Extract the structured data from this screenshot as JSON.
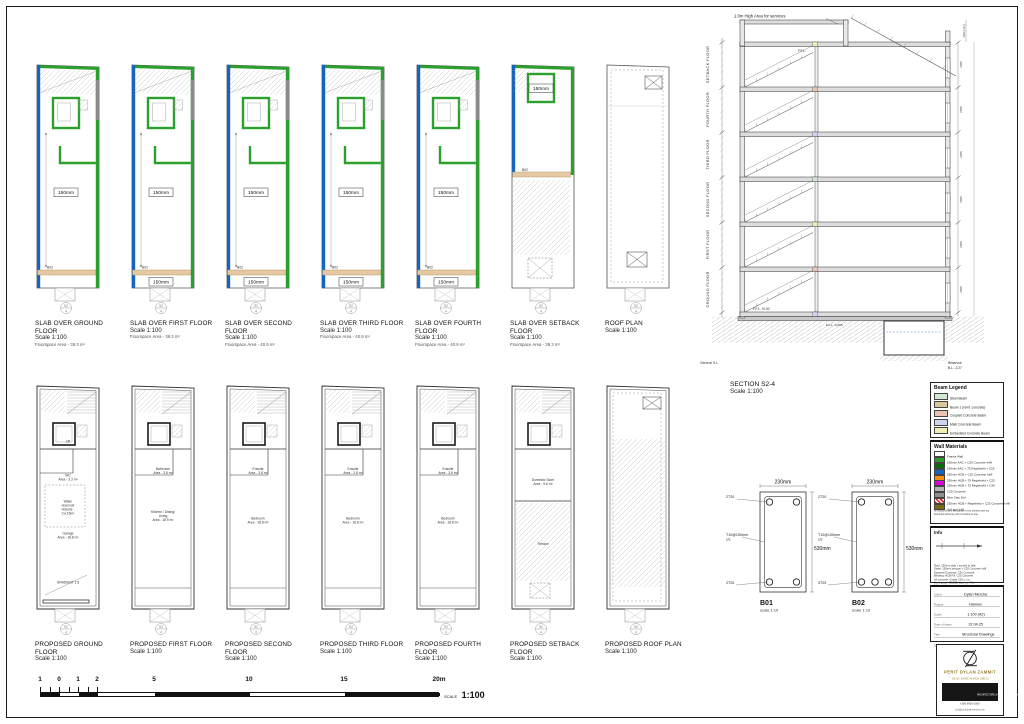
{
  "marker": {
    "top": "S2",
    "bottom": "4"
  },
  "plan_colors": {
    "blue": "#1565c0",
    "green": "#2ca02c",
    "gray": "#8a8a8a",
    "beam": "#e6c9a3"
  },
  "slab_plans": [
    {
      "title": "SLAB OVER GROUND FLOOR",
      "scale": "Scale 1:100",
      "area": "Floorspace Area - 39.3 m²",
      "variant": "slab",
      "center_label": "150mm",
      "bottom_label": "",
      "beam_label": "B02"
    },
    {
      "title": "SLAB OVER FIRST FLOOR",
      "scale": "Scale 1:100",
      "area": "Floorspace Area - 39.3 m²",
      "variant": "slab",
      "center_label": "150mm",
      "bottom_label": "150mm",
      "beam_label": "B02"
    },
    {
      "title": "SLAB OVER SECOND FLOOR",
      "scale": "Scale 1:100",
      "area": "Floorspace Area - 40.9 m²",
      "variant": "slab",
      "center_label": "150mm",
      "bottom_label": "150mm",
      "beam_label": "B02"
    },
    {
      "title": "SLAB OVER THIRD FLOOR",
      "scale": "Scale 1:100",
      "area": "Floorspace Area - 40.9 m²",
      "variant": "slab",
      "center_label": "150mm",
      "bottom_label": "150mm",
      "beam_label": "B02"
    },
    {
      "title": "SLAB OVER FOURTH FLOOR",
      "scale": "Scale 1:100",
      "area": "Floorspace Area - 40.9 m²",
      "variant": "slab",
      "center_label": "150mm",
      "bottom_label": "150mm",
      "beam_label": "B02"
    },
    {
      "title": "SLAB OVER SETBACK FLOOR",
      "scale": "Scale 1:100",
      "area": "Floorspace Area - 39.3 m²",
      "variant": "setback",
      "center_label": "150mm",
      "bottom_label": "",
      "beam_label": "B02"
    },
    {
      "title": "ROOF PLAN",
      "scale": "Scale 1:100",
      "area": "",
      "variant": "roof",
      "center_label": "",
      "bottom_label": "",
      "beam_label": ""
    }
  ],
  "proposed_plans": [
    {
      "title": "PROPOSED GROUND FLOOR",
      "scale": "Scale 1:100",
      "variant": "ground",
      "rooms": [
        {
          "lines": [
            "Lift"
          ],
          "y": 0.24
        },
        {
          "lines": [
            "WC",
            "Area - 3.3 m²"
          ],
          "y": 0.4
        },
        {
          "lines": [
            "Water",
            "reservoir",
            "Volume -",
            "Ca 15m³"
          ],
          "y": 0.52
        },
        {
          "lines": [
            "Garage",
            "Area - 18.8 m²"
          ],
          "y": 0.67
        },
        {
          "lines": [
            "GRADIENT 1:5"
          ],
          "y": 0.9
        }
      ]
    },
    {
      "title": "PROPOSED FIRST FLOOR",
      "scale": "Scale 1:100",
      "variant": "typical",
      "rooms": [
        {
          "lines": [
            "Bathroom",
            "Area - 3.8 m²"
          ],
          "y": 0.37
        },
        {
          "lines": [
            "Kitchen / Dining/",
            "Living",
            "Area - 18.9 m²"
          ],
          "y": 0.57
        }
      ]
    },
    {
      "title": "PROPOSED SECOND FLOOR",
      "scale": "Scale 1:100",
      "variant": "typical",
      "rooms": [
        {
          "lines": [
            "Ensuite",
            "Area - 3.8 m²"
          ],
          "y": 0.37
        },
        {
          "lines": [
            "Bedroom",
            "Area - 18.8 m²"
          ],
          "y": 0.6
        }
      ]
    },
    {
      "title": "PROPOSED THIRD FLOOR",
      "scale": "Scale 1:100",
      "variant": "typical",
      "rooms": [
        {
          "lines": [
            "Ensuite",
            "Area - 3.8 m²"
          ],
          "y": 0.37
        },
        {
          "lines": [
            "Bedroom",
            "Area - 18.8 m²"
          ],
          "y": 0.6
        }
      ]
    },
    {
      "title": "PROPOSED FOURTH FLOOR",
      "scale": "Scale 1:100",
      "variant": "typical",
      "rooms": [
        {
          "lines": [
            "Ensuite",
            "Area - 3.8 m²"
          ],
          "y": 0.37
        },
        {
          "lines": [
            "Bedroom",
            "Area - 18.8 m²"
          ],
          "y": 0.6
        }
      ]
    },
    {
      "title": "PROPOSED SETBACK FLOOR",
      "scale": "Scale 1:100",
      "variant": "setback",
      "rooms": [
        {
          "lines": [
            "Domestic Store",
            "Area - 9.6 m²"
          ],
          "y": 0.42
        },
        {
          "lines": [
            "Terrace"
          ],
          "y": 0.72
        }
      ]
    },
    {
      "title": "PROPOSED ROOF PLAN",
      "scale": "Scale 1:100",
      "variant": "roof",
      "rooms": []
    }
  ],
  "section": {
    "title": "SECTION S2-4",
    "scale": "Scale 1:100",
    "top_note": "1.0m High Area for services",
    "floor_labels": [
      "SETBACK FLOOR",
      "FOURTH FLOOR",
      "THIRD FLOOR",
      "SECOND FLOOR",
      "FIRST FLOOR",
      "GROUND FLOOR"
    ],
    "bottom_left_label": "General S.L.",
    "ffl_top": "F.F.L.",
    "ffl_ground": "F.F.L. +0.00",
    "ffl_lower": "F.F.L. -0.295",
    "reservoir_label": "Reservoir",
    "reservoir_level": "B.L. -2.27",
    "storey_dim": "2865",
    "top_dim": "1400 (min)"
  },
  "beam_details": {
    "items": [
      {
        "id": "B01",
        "scale": "scale 1:10",
        "width_dim": "230mm",
        "height_dim": "530mm",
        "top_bars": "2T20",
        "links": "T10@150mm",
        "links_cc": "c/c",
        "bottom_bars": "2T25",
        "n_bottom": 2
      },
      {
        "id": "B02",
        "scale": "scale 1:10",
        "width_dim": "230mm",
        "height_dim": "530mm",
        "top_bars": "2T20",
        "links": "T10@150mm",
        "links_cc": "c/c",
        "bottom_bars": "3T25",
        "n_bottom": 3
      }
    ]
  },
  "beam_legend": {
    "title": "Beam Legend",
    "items": [
      {
        "label": "Steel Beam",
        "color": "#d2e8d2"
      },
      {
        "label": "Beam 1 (reinf. concrete)",
        "color": "#d9c69b"
      },
      {
        "label": "Coupled Concrete Beam",
        "color": "#e9c4b3"
      },
      {
        "label": "Main Concrete Beam",
        "color": "#ccd4ee"
      },
      {
        "label": "Embedded Concrete Beam",
        "color": "#f1eeb2"
      }
    ]
  },
  "wall_materials": {
    "title": "Wall Materials",
    "items": [
      {
        "label": "Franka Wall",
        "color": "#ffffff"
      },
      {
        "label": "150mm AAC + C25 Concrete Infill",
        "color": "#2ca02c"
      },
      {
        "label": "150mm AAC + 75 Regishield + C25",
        "color": "#0a6b0a"
      },
      {
        "label": "230mm HCB + C25 Concrete Infill",
        "color": "#1565c0"
      },
      {
        "label": "230mm HCB + 75 Regishield + C25",
        "color": "#ff8c00"
      },
      {
        "label": "230mm HCB + 75 Regishield + C30",
        "color": "#dd00dd"
      },
      {
        "label": "C25 Concrete",
        "color": "#b5b5b5"
      },
      {
        "label": "Blue Clay Soil",
        "color": "#8f8f8f"
      },
      {
        "label": "230mm HCB + Regishield + C25 Concrete Infill",
        "color": "hatch"
      },
      {
        "label": "Soil and Infill",
        "color": "#7d6b12"
      }
    ],
    "note": "All sections and wall guides to be verified with full structural scheme prior to works on site."
  },
  "info": {
    "title": "Info",
    "notes": [
      "Roof: 150mm slab + screed to falls",
      "Slabs: 150mm precast + C25 Concrete Infill",
      "Exposed Concrete: C30 Concrete",
      "Blinding: HCB Fill, C25 Concrete",
      "All concrete: Grade C25 u.n.o.",
      "Steel grade: B500B, laps min 40ø",
      "All levels & sizes to be verified on site"
    ]
  },
  "title_block": {
    "rows": [
      {
        "label": "Client",
        "value": "Dylan Mercha"
      },
      {
        "label": "Project",
        "value": "Hamrun"
      },
      {
        "label": "Scale",
        "value": "1:100 (A2)"
      },
      {
        "label": "Date of Issue",
        "value": "22.04.25"
      },
      {
        "label": "Title",
        "value": "Structural Drawings"
      },
      {
        "label": "Drg No",
        "value": "002"
      }
    ]
  },
  "logo": {
    "name": "PERIT DYLAN ZAMMIT",
    "credentials": "B.E.&A. (HONS.) M.ARCH. (MELIT.)",
    "bar": "ARCHITECTURE & CIVIL ENGINEERING",
    "tel": "+356 9900 0000",
    "email": "info@peritdylanzammit.com"
  },
  "scale_bar": {
    "ticks": [
      {
        "label": "1",
        "m": -1
      },
      {
        "label": "0",
        "m": 0
      },
      {
        "label": "1",
        "m": 1
      },
      {
        "label": "2",
        "m": 2
      },
      {
        "label": "5",
        "m": 5
      },
      {
        "label": "10",
        "m": 10
      },
      {
        "label": "15",
        "m": 15
      },
      {
        "label": "20m",
        "m": 20
      }
    ],
    "scale_word": "SCALE",
    "scale_value": "1:100"
  }
}
